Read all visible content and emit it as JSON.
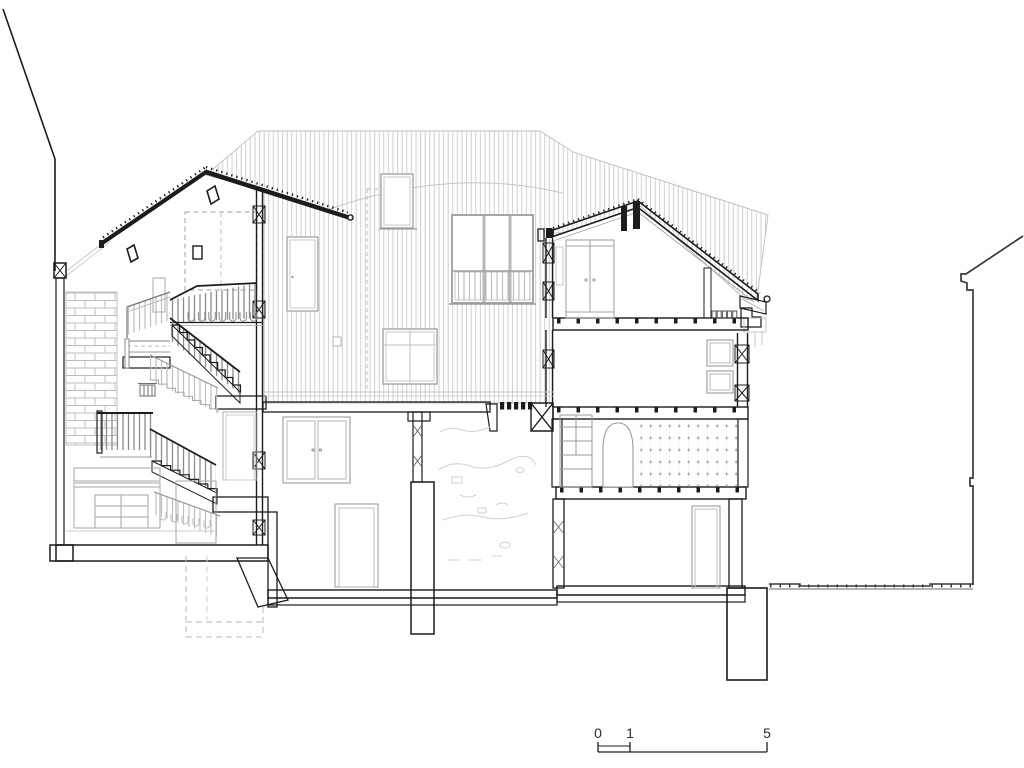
{
  "drawing": {
    "kind": "architectural building cross-section",
    "scale_bar": {
      "labels": [
        "0",
        "1",
        "5"
      ]
    },
    "colors": {
      "ink": "#1c1c1c",
      "light_gray": "#a4a4a4",
      "faint_gray": "#c6c6c6",
      "paper": "#ffffff"
    }
  }
}
